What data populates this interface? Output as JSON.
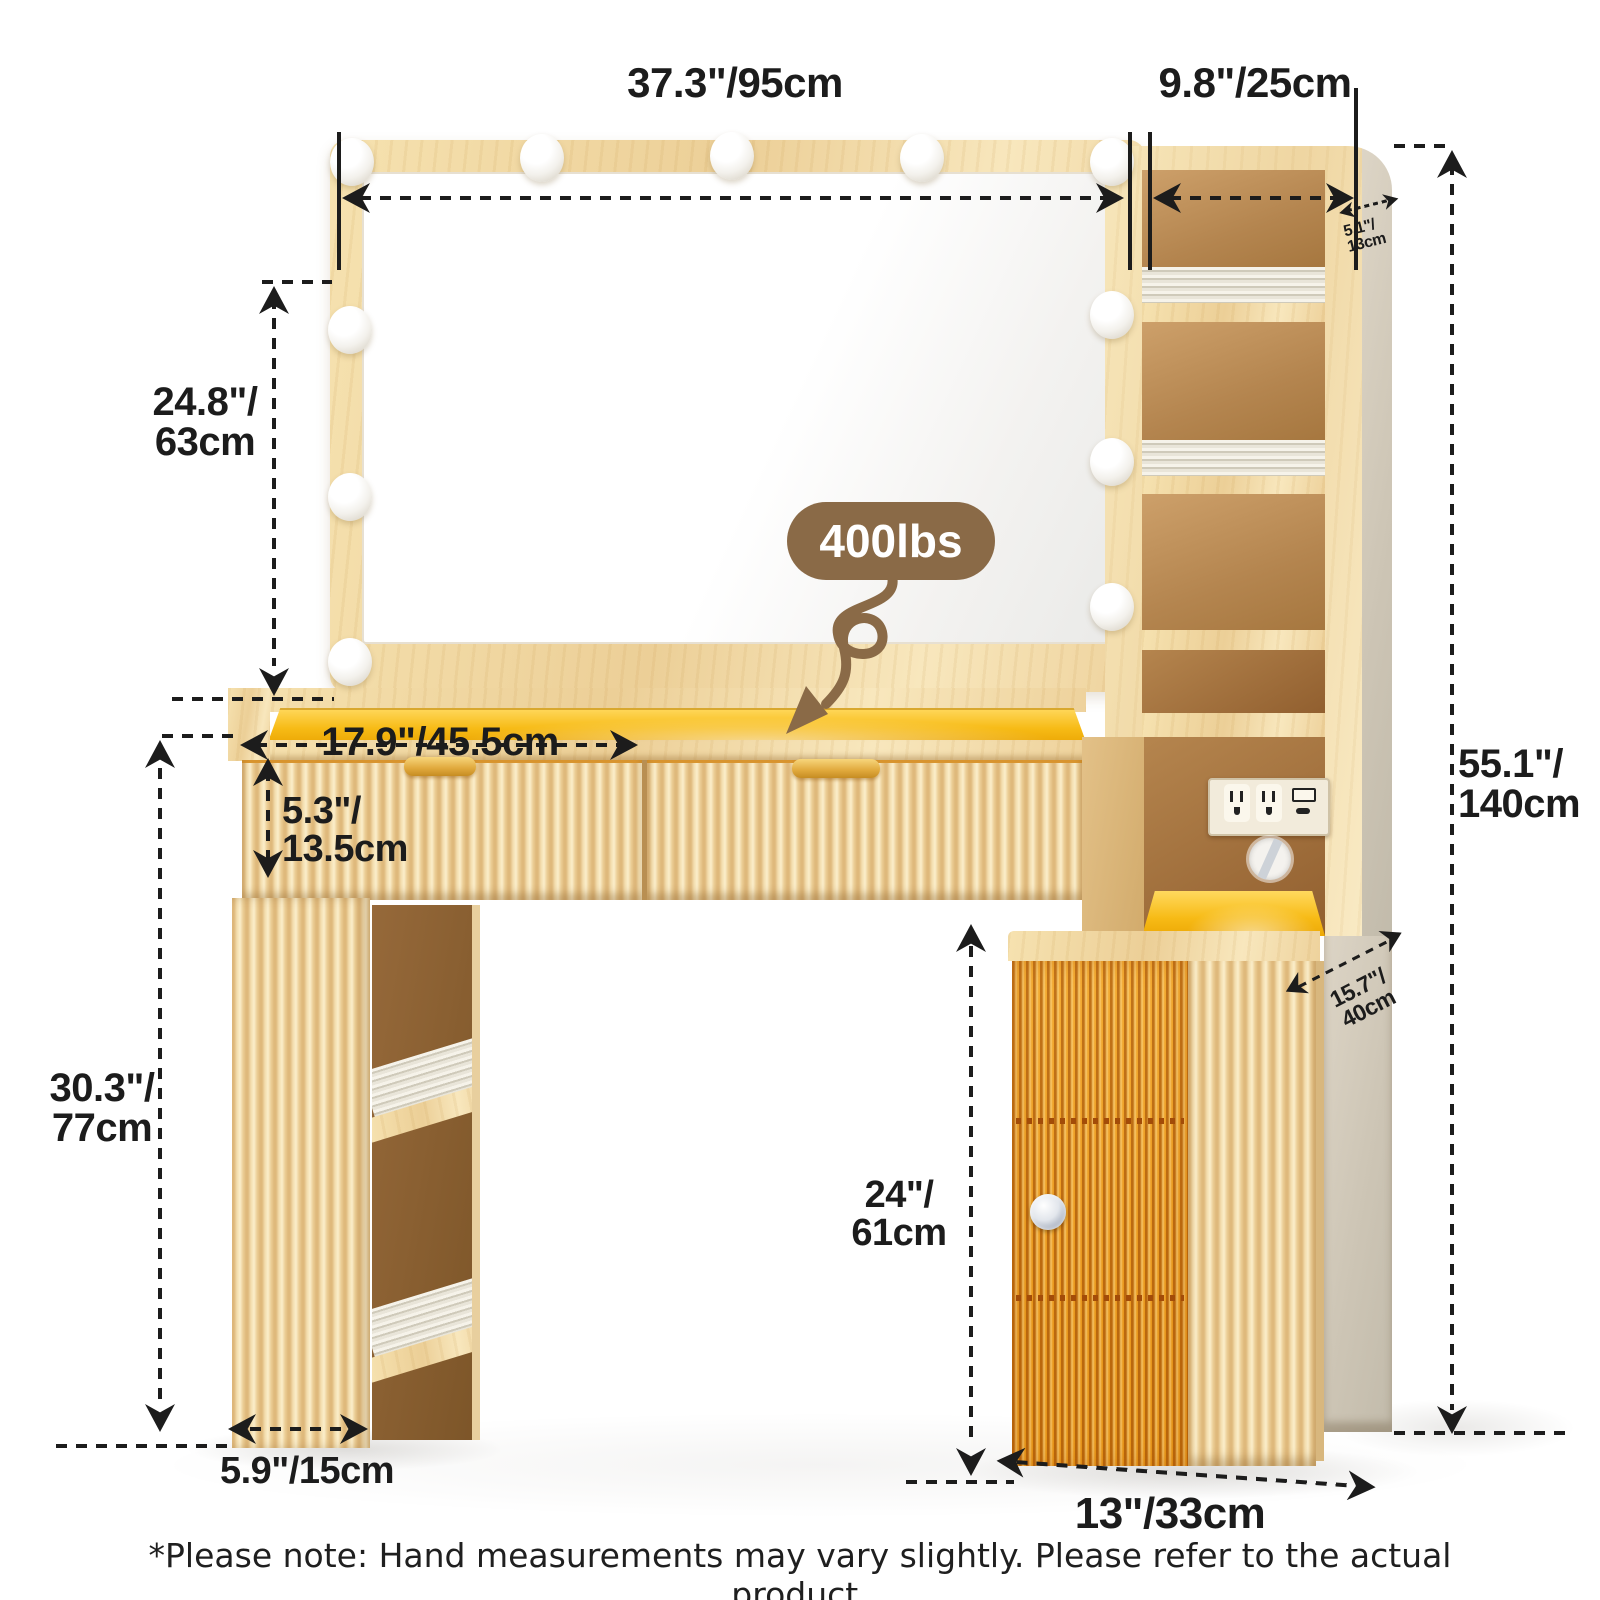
{
  "badge": {
    "label": "400lbs"
  },
  "dimensions": {
    "mirror_width": {
      "label": "37.3\"/95cm"
    },
    "top_shelf_width": {
      "label": "9.8\"/25cm"
    },
    "mirror_height": {
      "line1": "24.8\"/",
      "line2": "63cm"
    },
    "top_shelf_depth": {
      "line1": "5.1\"/",
      "line2": "13cm"
    },
    "overall_height": {
      "line1": "55.1\"/",
      "line2": "140cm"
    },
    "drawer_width": {
      "label": "17.9\"/45.5cm"
    },
    "drawer_height": {
      "line1": "5.3\"/",
      "line2": "13.5cm"
    },
    "desk_height": {
      "line1": "30.3\"/",
      "line2": "77cm"
    },
    "cabinet_door_height": {
      "line1": "24\"/",
      "line2": "61cm"
    },
    "leg_depth": {
      "label": "5.9\"/15cm"
    },
    "cabinet_width": {
      "label": "13\"/33cm"
    },
    "cabinet_depth": {
      "line1": "15.7\"/",
      "line2": "40cm"
    }
  },
  "footer": {
    "note": "*Please note: Hand measurements may vary slightly. Please refer to the actual product."
  },
  "colors": {
    "ink": "#1c1c1c",
    "brown": "#8a6a47",
    "yellow": "#f7bb16"
  }
}
